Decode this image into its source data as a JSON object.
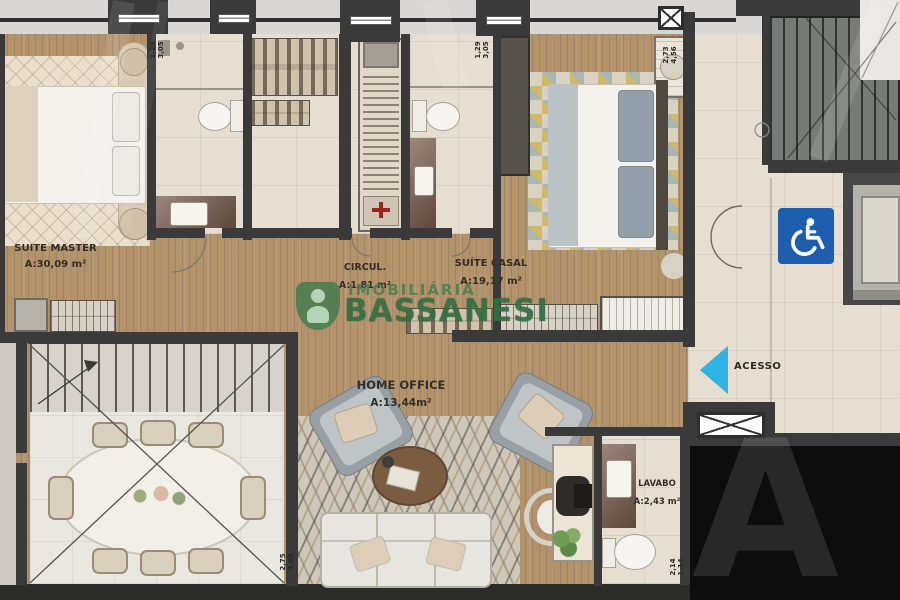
{
  "rooms": {
    "suite_master": {
      "name": "SUITE MASTER",
      "area": "A:30,09 m²"
    },
    "circulation": {
      "name": "CIRCUL.",
      "area": "A:1,81 m²"
    },
    "suite_casal": {
      "name": "SUÍTE CASAL",
      "area": "A:19,17 m²"
    },
    "home_office": {
      "name": "HOME OFFICE",
      "area": "A:13,44m²"
    },
    "lavabo": {
      "name": "LAVABO",
      "area": "A:2,43 m²"
    }
  },
  "access": {
    "label": "ACESSO"
  },
  "dimensions": {
    "master_bath": [
      "1,29",
      "3,05"
    ],
    "bath2": [
      "1,29",
      "3,05"
    ],
    "suite_casal_wall": [
      "2,73",
      "4,56"
    ],
    "home_office_wall": [
      "2,75",
      "4,89"
    ],
    "lavabo_wall": [
      "2,14",
      "1,14"
    ]
  },
  "watermark": {
    "brand_top": "IMOBILIÁRIA",
    "brand_main": "BASSANESI",
    "ghost_letter": "A"
  },
  "colors": {
    "accent_green": "#3e7c4e",
    "access_arrow_blue": "#2db3e4",
    "accessible_sign_blue": "#1d5fae",
    "wall_dark": "#3a3a3a",
    "wood_floor": "#b2936c"
  },
  "icons": {
    "wheelchair": "wheelchair-accessible-icon",
    "access_arrow": "access-arrow-icon"
  }
}
